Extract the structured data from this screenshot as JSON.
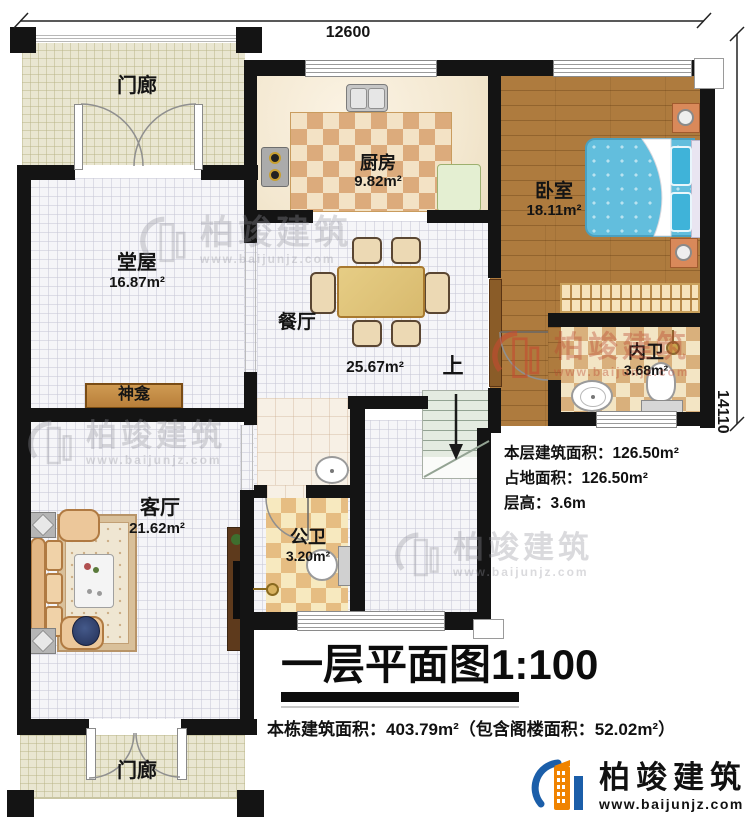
{
  "dimensions": {
    "top": "12600",
    "right": "14110"
  },
  "rooms": {
    "porch_top": {
      "name": "门廊"
    },
    "kitchen": {
      "name": "厨房",
      "area": "9.82m²"
    },
    "bedroom": {
      "name": "卧室",
      "area": "18.11m²"
    },
    "hall": {
      "name": "堂屋",
      "area": "16.87m²"
    },
    "dining": {
      "name": "餐厅",
      "area": "25.67m²"
    },
    "shrine": {
      "name": "神龛"
    },
    "inner_bath": {
      "name": "内卫",
      "area": "3.68m²"
    },
    "living": {
      "name": "客厅",
      "area": "21.62m²"
    },
    "public_bath": {
      "name": "公卫",
      "area": "3.20m²"
    },
    "porch_bottom": {
      "name": "门廊"
    },
    "stairs": {
      "up_label": "上"
    }
  },
  "stats": {
    "lines": [
      "本层建筑面积：126.50m²",
      "占地面积：126.50m²",
      "层高：3.6m"
    ]
  },
  "title": "一层平面图1:100",
  "footer_note": "本栋建筑面积：403.79m²（包含阁楼面积：52.02m²）",
  "brand": {
    "name": "柏竣建筑",
    "url": "www.baijunjz.com"
  },
  "watermark": {
    "name": "柏竣建筑",
    "url": "www.baijunjz.com"
  },
  "colors": {
    "wall": "#141414",
    "wood": "#ae7b3e",
    "bed": "#62bedd",
    "brand_blue": "#1b5ea9",
    "brand_orange": "#f08300"
  }
}
